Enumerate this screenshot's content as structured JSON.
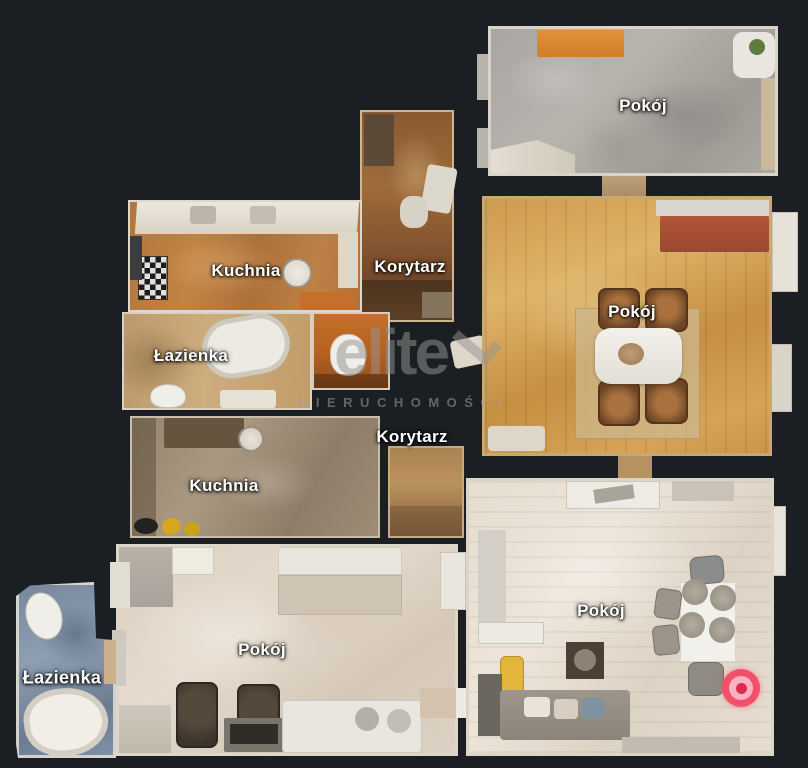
{
  "scene": {
    "type": "3D dollhouse floor plan view",
    "background_color": "#1b1f23"
  },
  "watermark": {
    "brand": "elite",
    "subtitle": "NIERUCHOMOŚCI"
  },
  "rooms": [
    {
      "id": "pokoj-top-right",
      "label": "Pokój"
    },
    {
      "id": "korytarz-top",
      "label": "Korytarz"
    },
    {
      "id": "kuchnia-top",
      "label": "Kuchnia"
    },
    {
      "id": "lazienka-top",
      "label": "Łazienka"
    },
    {
      "id": "pokoj-middle-right",
      "label": "Pokój"
    },
    {
      "id": "korytarz-middle",
      "label": "Korytarz"
    },
    {
      "id": "kuchnia-middle",
      "label": "Kuchnia"
    },
    {
      "id": "pokoj-bottom-left",
      "label": "Pokój"
    },
    {
      "id": "lazienka-bottom-left",
      "label": "Łazienka"
    },
    {
      "id": "pokoj-bottom-right",
      "label": "Pokój"
    }
  ],
  "marker": {
    "name": "camera-viewpoint",
    "outer_color": "#f0506a",
    "mid_color": "#f9b2bf",
    "inner_color": "#e02a4d"
  }
}
